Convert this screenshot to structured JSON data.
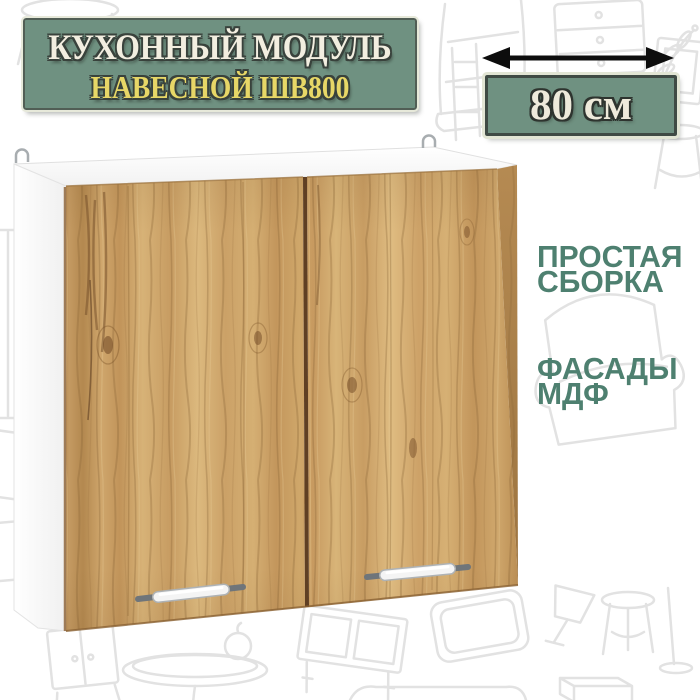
{
  "banner": {
    "title": "КУХОННЫЙ МОДУЛЬ",
    "subtitle": "НАВЕСНОЙ ШВ800"
  },
  "dimension": {
    "value": "80 см",
    "arrow_icon": "double-headed-width-arrow"
  },
  "features": [
    {
      "lines": [
        "ПРОСТАЯ",
        "СБОРКА"
      ]
    },
    {
      "lines": [
        "ФАСАДЫ",
        "МДФ"
      ]
    }
  ],
  "colors": {
    "banner_green": "#6f9181",
    "banner_border": "#515e55",
    "title_cream": "#f2eee0",
    "subtitle_yellow": "#e7d767",
    "feature_text_green": "#4e8070",
    "arrow_black": "#0d0d0d",
    "wood_mid": "#c89e64",
    "carcass_white": "#fdfdfd",
    "doodle_gray": "#e2e2e2"
  },
  "background": {
    "doodles": [
      "stool",
      "chair",
      "dresser",
      "ladder-shelf",
      "plant",
      "picture-frame",
      "wardrobe",
      "armchair",
      "cupboard",
      "round-table",
      "cabinet",
      "mirror-frame",
      "desk-lamp",
      "floor-lamp",
      "storage-box",
      "sofa"
    ]
  }
}
